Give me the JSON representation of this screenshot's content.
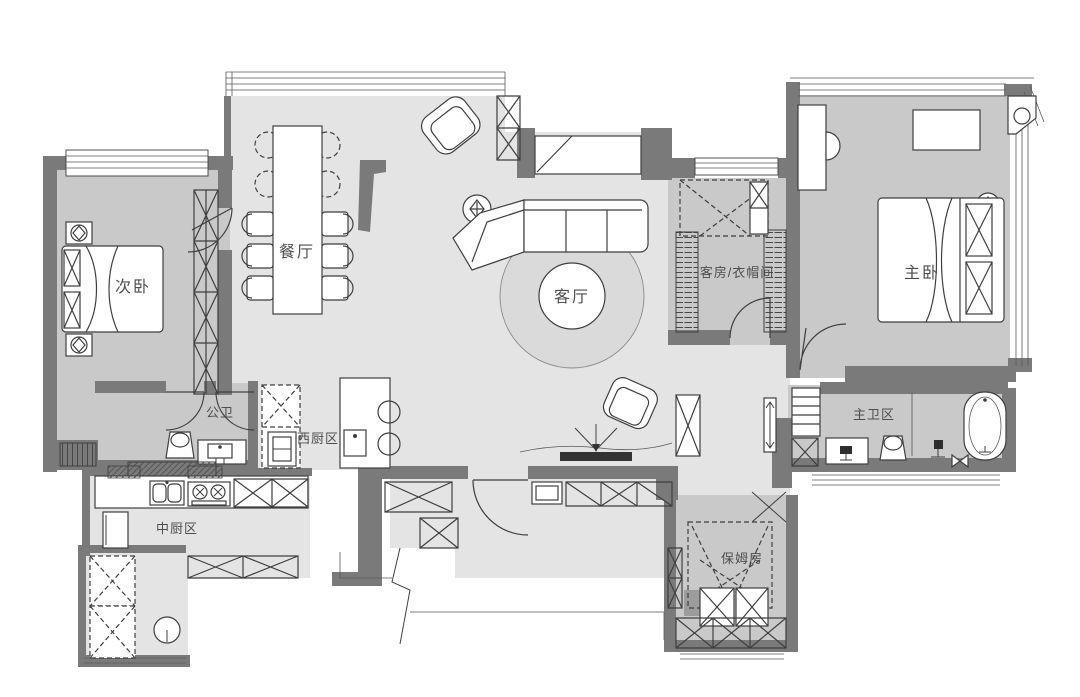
{
  "meta": {
    "type": "residential-floor-plan"
  },
  "colors": {
    "wall": "#7a7a7a",
    "floor_light": "#e4e4e4",
    "floor_dark": "#c9c9c9",
    "furniture_line": "#3f3f3f",
    "label_text": "#4e4e4e",
    "background": "#ffffff"
  },
  "rooms": [
    {
      "id": "secondary-bedroom",
      "label": "次卧"
    },
    {
      "id": "dining-room",
      "label": "餐厅"
    },
    {
      "id": "living-room",
      "label": "客厅"
    },
    {
      "id": "guest-room-cloakroom",
      "label": "客房/衣帽间"
    },
    {
      "id": "master-bedroom",
      "label": "主卧"
    },
    {
      "id": "guest-bathroom",
      "label": "公卫"
    },
    {
      "id": "western-kitchen",
      "label": "西厨区"
    },
    {
      "id": "chinese-kitchen",
      "label": "中厨区"
    },
    {
      "id": "master-bathroom",
      "label": "主卫区"
    },
    {
      "id": "nanny-room",
      "label": "保姆房"
    }
  ]
}
